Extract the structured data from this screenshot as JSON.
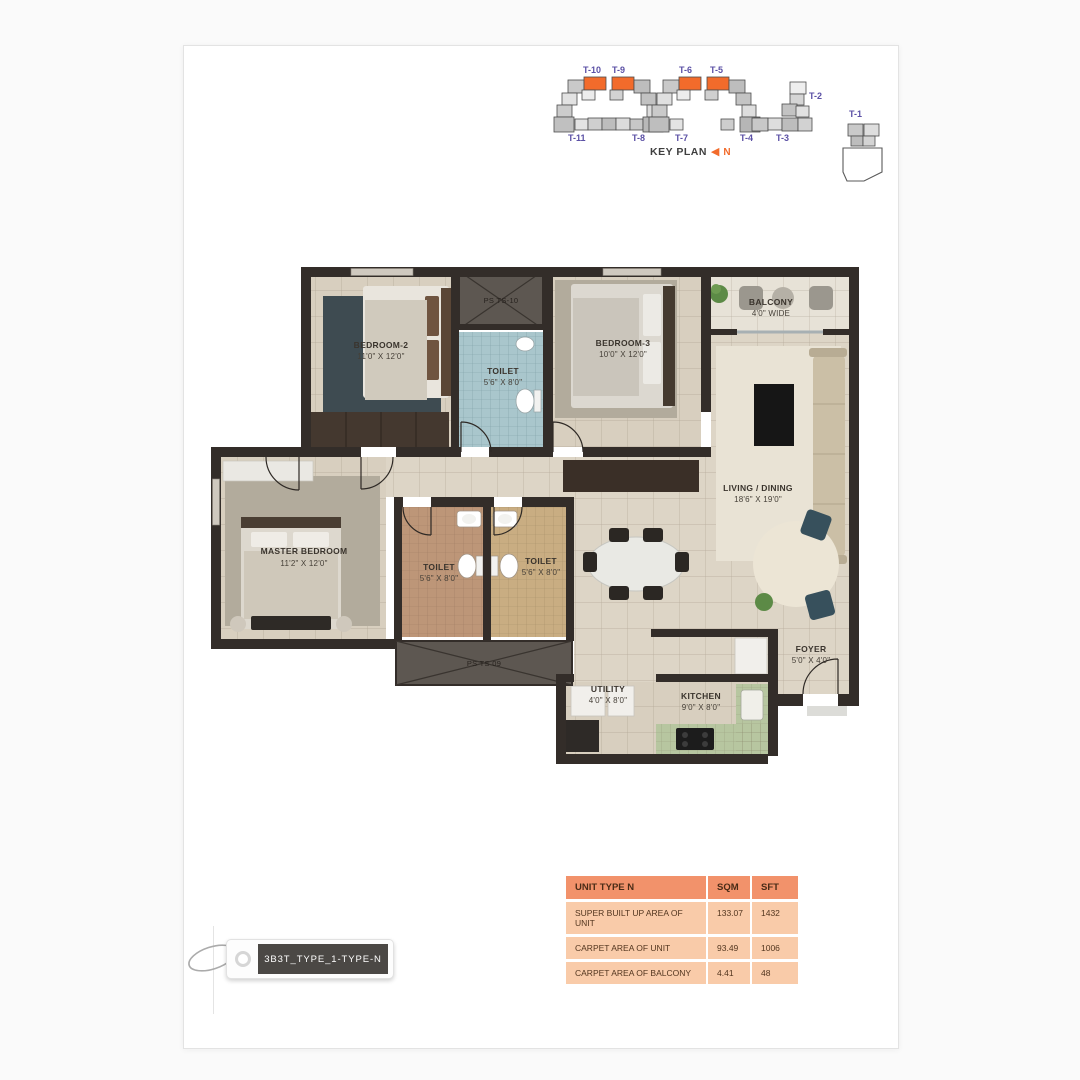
{
  "key_plan": {
    "title": "KEY PLAN",
    "north_arrow_icon": "◀",
    "north_label": "N",
    "towers": [
      {
        "label": "T-10",
        "highlighted": true
      },
      {
        "label": "T-9",
        "highlighted": true
      },
      {
        "label": "T-6",
        "highlighted": true
      },
      {
        "label": "T-5",
        "highlighted": true
      },
      {
        "label": "T-2",
        "highlighted": false
      },
      {
        "label": "T-11",
        "highlighted": false
      },
      {
        "label": "T-8",
        "highlighted": false
      },
      {
        "label": "T-7",
        "highlighted": false
      },
      {
        "label": "T-4",
        "highlighted": false
      },
      {
        "label": "T-3",
        "highlighted": false
      },
      {
        "label": "T-1",
        "highlighted": false
      }
    ]
  },
  "floor_plan": {
    "rooms": [
      {
        "name": "BEDROOM-2",
        "dims": "11'0\" X 12'0\""
      },
      {
        "name": "TOILET",
        "dims": "5'6\" X 8'0\""
      },
      {
        "name": "BEDROOM-3",
        "dims": "10'0\" X 12'0\""
      },
      {
        "name": "BALCONY",
        "dims": "4'0\" WIDE"
      },
      {
        "name": "LIVING / DINING",
        "dims": "18'6\" X 19'0\""
      },
      {
        "name": "MASTER BEDROOM",
        "dims": "11'2\" X 12'0\""
      },
      {
        "name": "TOILET",
        "dims": "5'6\" X 8'0\""
      },
      {
        "name": "TOILET",
        "dims": "5'6\" X 8'0\""
      },
      {
        "name": "UTILITY",
        "dims": "4'0\" X 8'0\""
      },
      {
        "name": "KITCHEN",
        "dims": "9'0\" X 8'0\""
      },
      {
        "name": "FOYER",
        "dims": "5'0\" X 4'0\""
      }
    ],
    "shafts": [
      {
        "label": "PS TS-10"
      },
      {
        "label": "PS TS 09"
      }
    ]
  },
  "area_table": {
    "header": {
      "col1": "UNIT TYPE N",
      "col2": "SQM",
      "col3": "SFT"
    },
    "rows": [
      {
        "label": "SUPER BUILT UP AREA OF UNIT",
        "sqm": "133.07",
        "sft": "1432"
      },
      {
        "label": "CARPET AREA OF UNIT",
        "sqm": "93.49",
        "sft": "1006"
      },
      {
        "label": "CARPET AREA OF BALCONY",
        "sqm": "4.41",
        "sft": "48"
      }
    ]
  },
  "tag": {
    "label": "3B3T_TYPE_1-TYPE-N"
  },
  "colors": {
    "accent_orange": "#f26b2b",
    "tower_label_purple": "#5b50a5",
    "table_header": "#f2926b",
    "table_row": "#f9cba9",
    "wall": "#332d29"
  }
}
